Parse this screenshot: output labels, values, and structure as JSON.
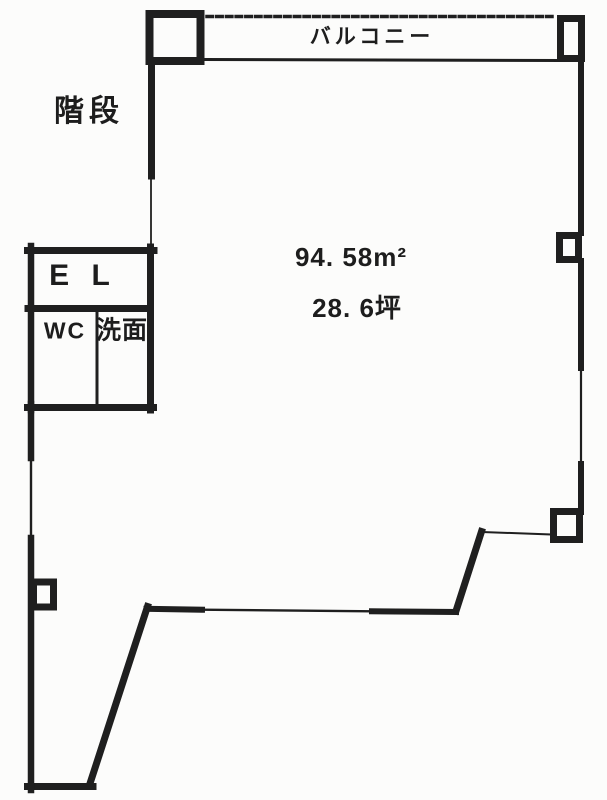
{
  "labels": {
    "stairs": "階段",
    "balcony": "バルコニー",
    "elevator": "E L",
    "toilet": "WC",
    "washroom": "洗面"
  },
  "areas": {
    "square_meters": "94. 58m²",
    "tsubo": "28. 6坪"
  },
  "colors": {
    "ink": "#1f1f1f",
    "paper": "#fcfcfb"
  }
}
